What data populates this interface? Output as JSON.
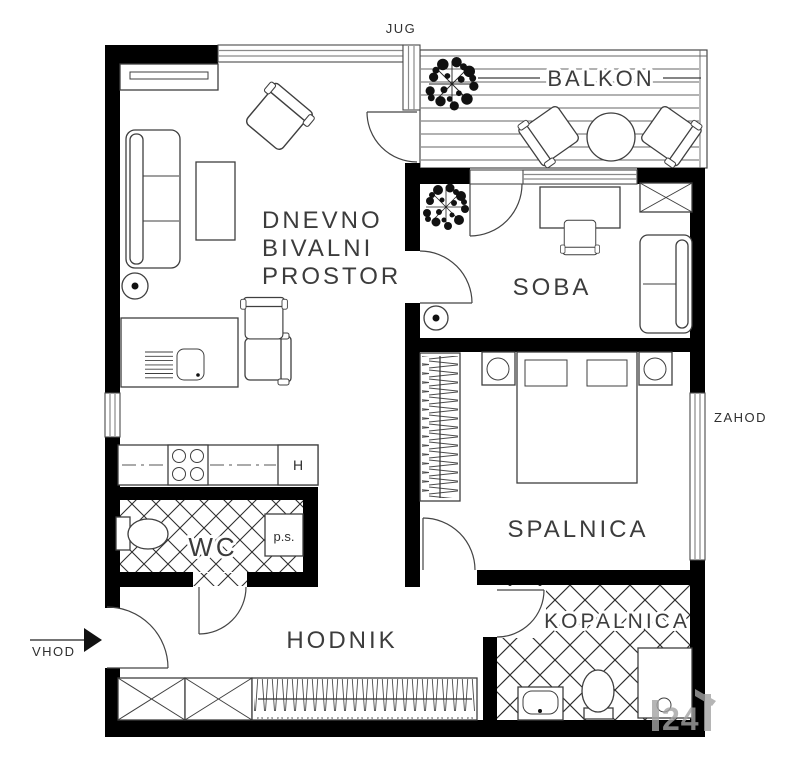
{
  "compass": {
    "south_label": "JUG",
    "west_label": "ZAHOD"
  },
  "entrance": {
    "label": "VHOD"
  },
  "rooms": {
    "living": {
      "label_line1": "DNEVNO",
      "label_line2": "BIVALNI",
      "label_line3": "PROSTOR"
    },
    "balcony": {
      "label": "BALKON"
    },
    "room": {
      "label": "SOBA"
    },
    "bedroom": {
      "label": "SPALNICA"
    },
    "bathroom": {
      "label": "KOPALNICA"
    },
    "hallway": {
      "label": "HODNIK"
    },
    "wc": {
      "label": "WC"
    }
  },
  "appliances": {
    "fridge_label": "H",
    "washing_machine_label": "p.s."
  },
  "watermark": {
    "text": "24"
  },
  "colors": {
    "wall": "#000000",
    "line": "#3f3f3f",
    "text": "#3a3a3a",
    "window": "#8a8a8a",
    "watermark": "#a3a3a3"
  }
}
